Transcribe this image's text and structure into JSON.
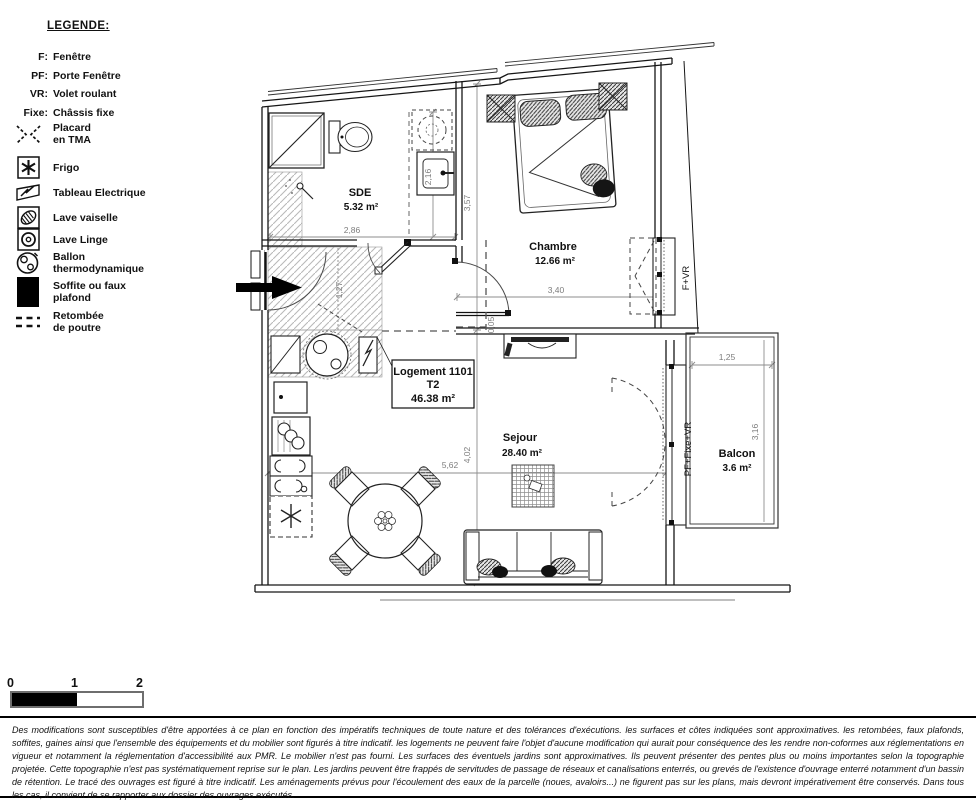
{
  "legend": {
    "title": "LEGENDE:",
    "abbr": [
      {
        "key": "F:",
        "label": "Fenêtre"
      },
      {
        "key": "PF:",
        "label": "Porte Fenêtre"
      },
      {
        "key": "VR:",
        "label": "Volet roulant"
      },
      {
        "key": "Fixe:",
        "label": "Châssis fixe"
      }
    ],
    "symbols": [
      {
        "icon": "placard-icon",
        "label": "Placard\nen TMA"
      },
      {
        "icon": "frigo-icon",
        "label": "Frigo"
      },
      {
        "icon": "tableau-electrique-icon",
        "label": "Tableau Electrique"
      },
      {
        "icon": "lave-vaisselle-icon",
        "label": "Lave vaiselle"
      },
      {
        "icon": "lave-linge-icon",
        "label": "Lave Linge"
      },
      {
        "icon": "ballon-thermodynamique-icon",
        "label": "Ballon\nthermodynamique"
      },
      {
        "icon": "soffite-icon",
        "label": "Soffite ou faux\nplafond"
      },
      {
        "icon": "retombee-poutre-icon",
        "label": "Retombée\nde poutre"
      }
    ]
  },
  "plan": {
    "unit": {
      "name": "Logement 1101",
      "type": "T2",
      "area": "46.38 m²"
    },
    "rooms": {
      "sde": {
        "name": "SDE",
        "area": "5.32 m²"
      },
      "chambre": {
        "name": "Chambre",
        "area": "12.66 m²"
      },
      "sejour": {
        "name": "Sejour",
        "area": "28.40 m²"
      },
      "balcon": {
        "name": "Balcon",
        "area": "3.6 m²"
      }
    },
    "windows": {
      "chambre": "F+VR",
      "sejour": "PF+Fixe+VR"
    },
    "dims": {
      "sde_w": "2,86",
      "sde_h": "2,16",
      "chambre_w": "3,40",
      "chambre_h": "3,57",
      "wall": "0,05",
      "hall": "1,27",
      "sejour_w": "5,62",
      "sejour_h": "4,02",
      "balcon_w": "1,25",
      "balcon_h": "3,16"
    }
  },
  "scalebar": {
    "t0": "0",
    "t1": "1",
    "t2": "2"
  },
  "disclaimer": "Des modifications sont susceptibles d'être apportées à ce plan en fonction des impératifs techniques de toute nature et des tolérances d'exécutions. les surfaces et côtes indiquées sont approximatives. les retombées, faux plafonds, soffites, gaines ainsi que l'ensemble des équipements et du mobilier sont figurés à titre indicatif. les logements ne peuvent faire l'objet d'aucune modification qui aurait pour conséquence des les rendre non-coformes aux réglementations en vigueur et notamment la réglementation d'accessibilité aux PMR. Le mobilier n'est pas fourni. Les surfaces des éventuels jardins sont approximatives. Ils peuvent présenter des pentes plus ou moins importantes selon la topographie projetée. Cette topographie n'est pas systématiquement reprise sur le plan. Les jardins peuvent être frappés de servitudes de passage de réseaux et canalisations enterrés, ou grevés de l'existence d'ouvrage enterré notamment d'un bassin de rétention. Le tracé des ouvrages est figuré à titre indicatif. Les aménagements prévus pour l'écoulement des eaux de la parcelle (noues, avaloirs...) ne figurent pas sur les plans, mais devront impérativement être conservés. Dans tous les cas, il convient de se rapporter aux dossier des ouvrages exécutés."
}
